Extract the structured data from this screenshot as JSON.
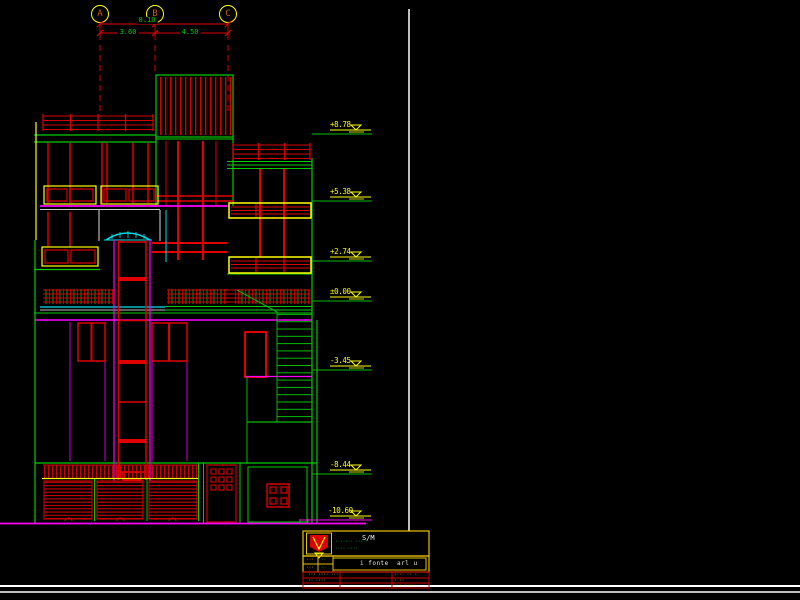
{
  "colors": {
    "background": "#000000",
    "line_red": "#e00000",
    "line_green": "#00cc00",
    "line_yellow": "#ffff00",
    "line_magenta": "#ff00ff",
    "line_cyan": "#00e0ee",
    "line_white": "#ffffff"
  },
  "grid": {
    "bubbles": [
      {
        "label": "A"
      },
      {
        "label": "B"
      },
      {
        "label": "C"
      }
    ],
    "dim_total": "8.10",
    "dim_ab": "3.60",
    "dim_bc": "4.50"
  },
  "elevation_markers": [
    {
      "value": "+8.78"
    },
    {
      "value": "+5.38"
    },
    {
      "value": "+2.74"
    },
    {
      "value": "±0.00"
    },
    {
      "value": "-3.45"
    },
    {
      "value": "-8.44"
    },
    {
      "value": "-10.60"
    }
  ],
  "title_block": {
    "code": "S/M",
    "doc_label": "i fonte  arl u",
    "company_line1": "······· ·····",
    "company_line2": "···· ····",
    "cell_1": "···",
    "cell_2": "··",
    "cell_3": "···",
    "cell_4": "··",
    "row1_left": "··· ···· ···",
    "row1_right": "···· ·· ·",
    "row2_left": "·· ····",
    "row2_right": "· ··",
    "row3_left": "····",
    "row3_right": "··· ····"
  }
}
